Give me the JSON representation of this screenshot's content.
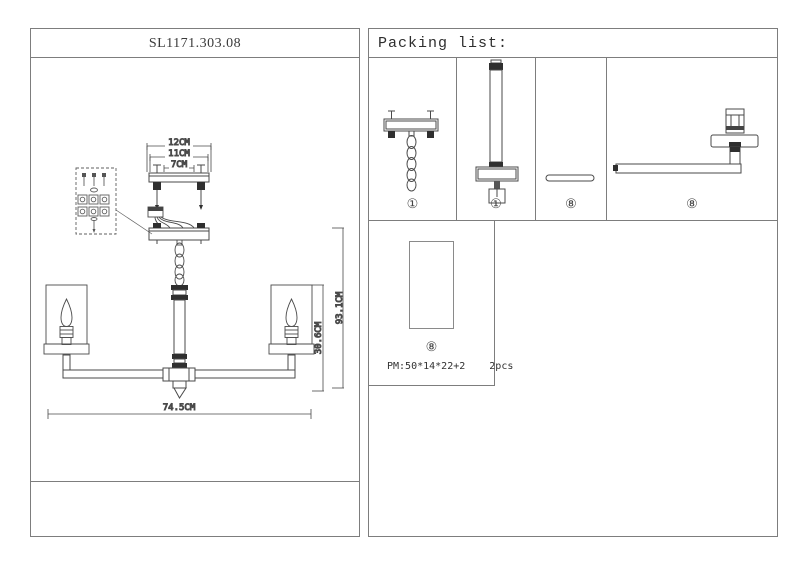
{
  "left_panel": {
    "title": "SL1171.303.08",
    "dimensions": {
      "top1": "12CM",
      "top2": "11CM",
      "top3": "7CM",
      "height_total": "93.1CM",
      "height_shade": "30.6CM",
      "width_total": "74.5CM"
    }
  },
  "right_panel": {
    "header": "Packing list:",
    "items": [
      {
        "part": "canopy-with-chain",
        "label": "①"
      },
      {
        "part": "center-rod-with-hub",
        "label": "①"
      },
      {
        "part": "flat-bar",
        "label": "⑧"
      },
      {
        "part": "lamp-arm",
        "label": "⑧"
      },
      {
        "part": "glass-shade",
        "label": "⑧"
      }
    ],
    "packing_note": {
      "size": "PM:50*14*22+2",
      "qty": "2pcs"
    }
  }
}
